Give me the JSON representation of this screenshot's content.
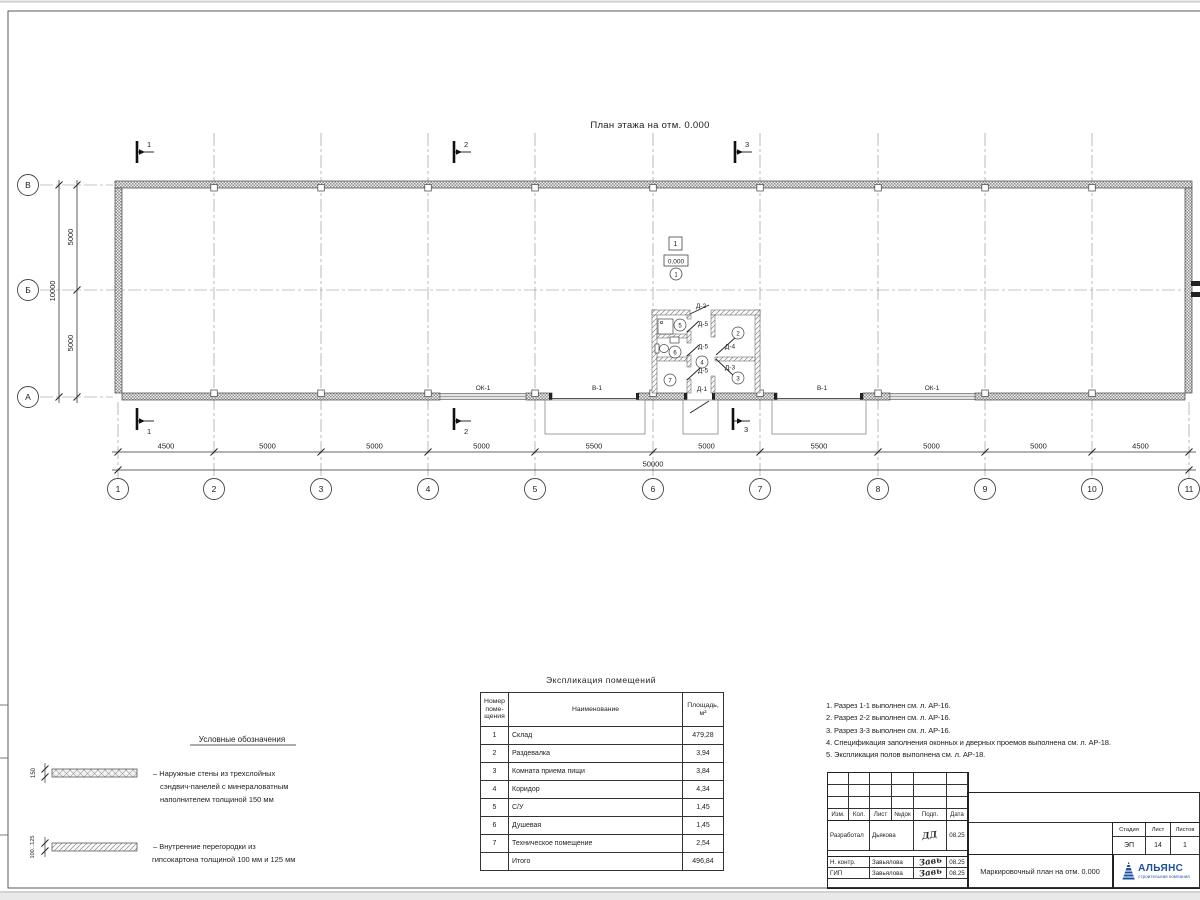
{
  "plan": {
    "title": "План этажа на отм. 0.000",
    "grid_cols": [
      "1",
      "2",
      "3",
      "4",
      "5",
      "6",
      "7",
      "8",
      "9",
      "10",
      "11"
    ],
    "grid_rows": [
      "В",
      "Б",
      "А"
    ],
    "dims_bottom": [
      "4500",
      "5000",
      "5000",
      "5000",
      "5500",
      "5000",
      "5500",
      "5000",
      "5000",
      "4500"
    ],
    "dim_total_bottom": "50000",
    "dims_left": [
      "5000",
      "5000"
    ],
    "dim_total_left": "10000",
    "section_labels": [
      "1",
      "2",
      "3"
    ],
    "floor_tag": "1",
    "elevation": "0.000",
    "rooms": [
      "1",
      "2",
      "3",
      "4",
      "5",
      "6",
      "7"
    ],
    "openings": {
      "ok1": "ОК-1",
      "v1": "В-1",
      "d1": "Д-1",
      "d2": "Д-2",
      "d3": "Д-3",
      "d4": "Д-4",
      "d5": "Д-5"
    }
  },
  "legend": {
    "title": "Условные обозначения",
    "items": [
      {
        "dim": "150",
        "lines": [
          "– Наружные стены из трехслойных",
          "сэндвич-панелей с минераловатным",
          "наполнителем толщиной 150 мм"
        ]
      },
      {
        "dim": "100...125",
        "lines": [
          "– Внутренние перегородки из",
          "гипсокартона толщиной 100 мм и 125 мм"
        ]
      }
    ]
  },
  "explication": {
    "title": "Экспликация помещений",
    "headers": {
      "num": [
        "Номер",
        "поме-",
        "щения"
      ],
      "name": "Наименование",
      "area": [
        "Площадь,",
        "м²"
      ]
    },
    "rows": [
      {
        "num": "1",
        "name": "Склад",
        "area": "479,28"
      },
      {
        "num": "2",
        "name": "Раздевалка",
        "area": "3,94"
      },
      {
        "num": "3",
        "name": "Комната приема пищи",
        "area": "3,84"
      },
      {
        "num": "4",
        "name": "Коридор",
        "area": "4,34"
      },
      {
        "num": "5",
        "name": "С/У",
        "area": "1,45"
      },
      {
        "num": "6",
        "name": "Душевая",
        "area": "1,45"
      },
      {
        "num": "7",
        "name": "Техническое помещение",
        "area": "2,54"
      },
      {
        "num": "",
        "name": "Итого",
        "area": "496,84"
      }
    ]
  },
  "notes": [
    "1. Разрез 1-1 выполнен см. л. АР-16.",
    "2. Разрез 2-2 выполнен см. л. АР-16.",
    "3. Разрез 3-3 выполнен см. л. АР-16.",
    "4. Спецификация заполнения оконных и дверных проемов выполнена см. л. АР-18.",
    "5. Экспликация полов выполнена см. л. АР-18."
  ],
  "titleblock": {
    "rev_headers": [
      "Изм.",
      "Кол.",
      "Лист",
      "№док",
      "Подп.",
      "Дата"
    ],
    "sign_rows": [
      {
        "role": "Разработал",
        "name": "Дьякова",
        "sig": "ДД",
        "date": "08.25"
      },
      {
        "role": "Н. контр.",
        "name": "Завьялова",
        "sig": "Завь",
        "date": "08.25"
      },
      {
        "role": "ГИП",
        "name": "Завьялова",
        "sig": "Завь",
        "date": "08.25"
      }
    ],
    "doc_name": "Маркировочный план на отм. 0.000",
    "stage_header": "Стадия",
    "sheet_header": "Лист",
    "sheets_header": "Листов",
    "stage": "ЭП",
    "sheet": "14",
    "sheets": "1",
    "company": "АЛЬЯНС",
    "company_sub": "строительная компания",
    "brand_color": "#1c4f9c"
  }
}
